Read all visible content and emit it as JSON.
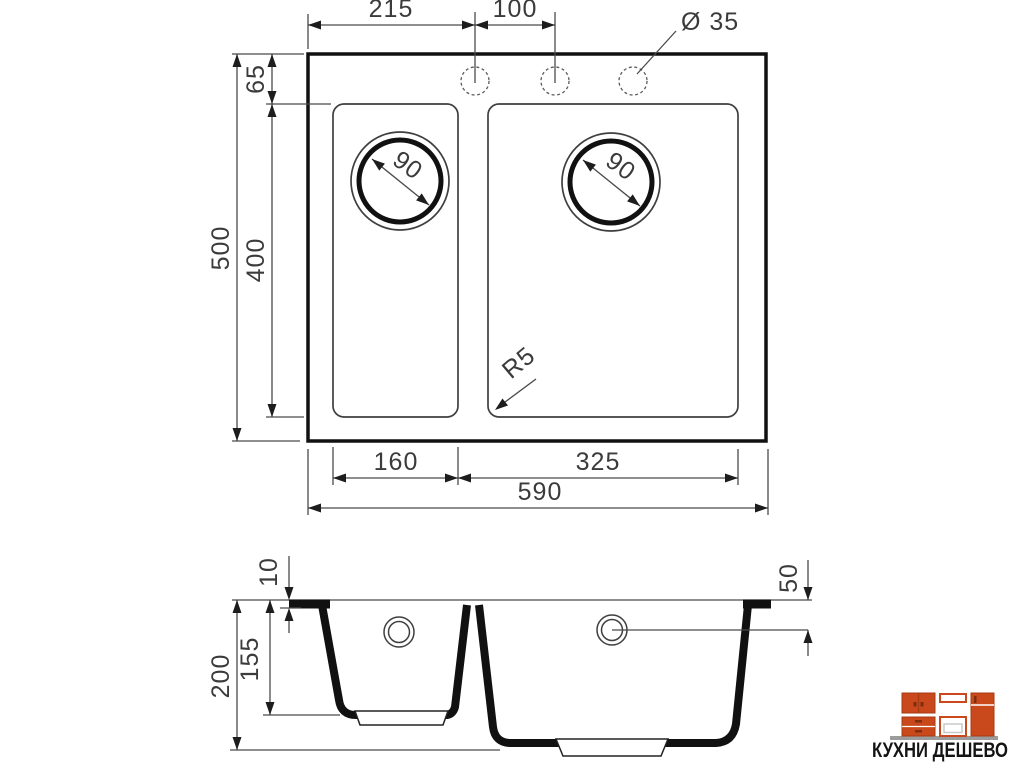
{
  "colors": {
    "background": "#ffffff",
    "thin_line": "#4a4a4a",
    "thick_line": "#111111",
    "dim_text": "#3b3b3b",
    "logo_accent": "#c9491c",
    "logo_accent_dark": "#a63c14",
    "logo_floor": "#9c9c9c",
    "logo_text": "#141414"
  },
  "top_view": {
    "dim_hole_offset": "215",
    "dim_hole_spacing": "100",
    "dim_hole_diameter": "Ø 35",
    "dim_rim_to_bowl": "65",
    "dim_bowl_depth": "400",
    "dim_total_depth": "500",
    "dim_left_bowl_width": "160",
    "dim_right_bowl_width": "325",
    "dim_total_width": "590",
    "dim_drain_left": "90",
    "dim_drain_right": "90",
    "dim_corner_radius": "R5"
  },
  "section_view": {
    "dim_rim_thickness": "10",
    "dim_drain_offset": "50",
    "dim_left_bowl_depth": "155",
    "dim_total_height": "200"
  },
  "logo": {
    "title": "КУХНИ ДЕШЕВО"
  }
}
